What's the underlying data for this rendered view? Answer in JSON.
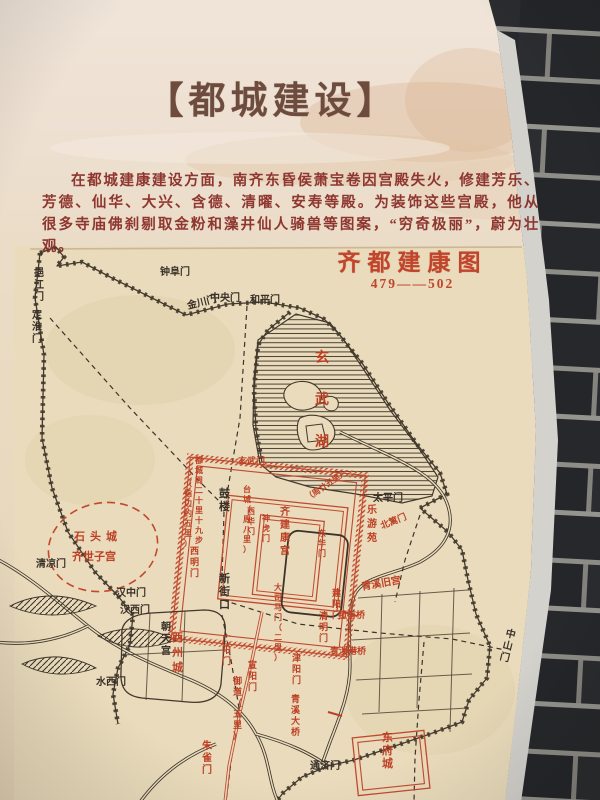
{
  "photo": {
    "colors": {
      "brick_wall": "#222426",
      "mortar": "#96948f",
      "panel_paper": "#ebdfca",
      "panel_edge": "#d4d2cd"
    }
  },
  "panel": {
    "title": "【都城建设】",
    "intro": "在都城建康建设方面，南齐东昏侯萧宝卷因宫殿失火，修建芳乐、芳德、仙华、大兴、含德、清曜、安寿等殿。为装饰这些宫殿，他从很多寺庙佛刹剔取金粉和藻井仙人骑兽等图案，“穷奇极丽”，蔚为壮观。"
  },
  "map": {
    "title": "齐都建康图",
    "period": "479——502",
    "colors": {
      "red": "#bd4026",
      "ink": "#39312a",
      "paper": "#e9dbbb"
    },
    "labels": [
      {
        "t": "钟阜门",
        "x": 160,
        "y": 275,
        "c": "ink",
        "o": "h",
        "s": 10
      },
      {
        "t": "金川门",
        "x": 188,
        "y": 309,
        "c": "ink",
        "o": "h",
        "s": 10,
        "r": -14
      },
      {
        "t": "中央门",
        "x": 210,
        "y": 301,
        "c": "ink",
        "o": "h",
        "s": 10
      },
      {
        "t": "和平门",
        "x": 250,
        "y": 303,
        "c": "ink",
        "o": "h",
        "s": 10
      },
      {
        "t": "挹江门",
        "x": 34,
        "y": 276,
        "c": "ink",
        "o": "v",
        "s": 10
      },
      {
        "t": "定淮门",
        "x": 32,
        "y": 318,
        "c": "ink",
        "o": "v",
        "s": 10
      },
      {
        "t": "太平门",
        "x": 373,
        "y": 501,
        "c": "ink",
        "o": "h",
        "s": 10
      },
      {
        "t": "清凉门",
        "x": 36,
        "y": 567,
        "c": "ink",
        "o": "h",
        "s": 10
      },
      {
        "t": "汉中门",
        "x": 116,
        "y": 596,
        "c": "ink",
        "o": "h",
        "s": 10
      },
      {
        "t": "汉西门",
        "x": 120,
        "y": 613,
        "c": "ink",
        "o": "h",
        "s": 10
      },
      {
        "t": "水西门",
        "x": 96,
        "y": 685,
        "c": "ink",
        "o": "h",
        "s": 10
      },
      {
        "t": "通济门",
        "x": 310,
        "y": 769,
        "c": "ink",
        "o": "h",
        "s": 10
      },
      {
        "t": "中山门",
        "x": 505,
        "y": 636,
        "c": "ink",
        "o": "v",
        "s": 10,
        "r": 14
      },
      {
        "t": "鼓楼",
        "x": 219,
        "y": 497,
        "c": "ink",
        "o": "v",
        "s": 11
      },
      {
        "t": "新街口",
        "x": 219,
        "y": 582,
        "c": "ink",
        "o": "v",
        "s": 11
      },
      {
        "t": "朝天宫",
        "x": 161,
        "y": 630,
        "c": "ink",
        "o": "v",
        "s": 10
      },
      {
        "t": "玄武门",
        "x": 238,
        "y": 464,
        "c": "red",
        "o": "h",
        "s": 9
      },
      {
        "t": "玄武湖",
        "x": 315,
        "y": 362,
        "c": "red",
        "o": "v",
        "s": 14,
        "ls": 28
      },
      {
        "t": "乐游苑",
        "x": 367,
        "y": 513,
        "c": "red",
        "o": "v",
        "s": 10,
        "ls": 4
      },
      {
        "t": "北篱门",
        "x": 382,
        "y": 529,
        "c": "red",
        "o": "h",
        "s": 9,
        "r": -22
      },
      {
        "t": "青溪旧宫",
        "x": 362,
        "y": 590,
        "c": "red",
        "o": "h",
        "s": 10,
        "r": -10
      },
      {
        "t": "菰首桥",
        "x": 338,
        "y": 618,
        "c": "red",
        "o": "h",
        "s": 9
      },
      {
        "t": "青溪港桥",
        "x": 330,
        "y": 654,
        "c": "red",
        "o": "h",
        "s": 9
      },
      {
        "t": "青溪大桥",
        "x": 291,
        "y": 702,
        "c": "red",
        "o": "v",
        "s": 9
      },
      {
        "t": "石头城",
        "x": 74,
        "y": 540,
        "c": "red",
        "o": "h",
        "s": 11,
        "ls": 5
      },
      {
        "t": "齐世子宫",
        "x": 72,
        "y": 560,
        "c": "red",
        "o": "h",
        "s": 11
      },
      {
        "t": "西州城",
        "x": 172,
        "y": 641,
        "c": "red",
        "o": "v",
        "s": 11,
        "ls": 4
      },
      {
        "t": "东府城",
        "x": 382,
        "y": 741,
        "c": "red",
        "o": "v",
        "s": 11,
        "ls": 2
      },
      {
        "t": "御道（五里）",
        "x": 233,
        "y": 684,
        "c": "red",
        "o": "v",
        "s": 9
      },
      {
        "t": "朱雀门",
        "x": 202,
        "y": 749,
        "c": "red",
        "o": "v",
        "s": 10
      },
      {
        "t": "齐建康宫",
        "x": 280,
        "y": 515,
        "c": "red",
        "o": "v",
        "s": 10,
        "ls": 3
      },
      {
        "t": "台城（周八里）",
        "x": 243,
        "y": 492,
        "c": "red",
        "o": "v",
        "s": 8
      },
      {
        "t": "大司马门（二里）",
        "x": 274,
        "y": 590,
        "c": "red",
        "o": "v",
        "s": 8
      },
      {
        "t": "西华门",
        "x": 247,
        "y": 514,
        "c": "red",
        "o": "v",
        "s": 8
      },
      {
        "t": "神虎门",
        "x": 262,
        "y": 521,
        "c": "red",
        "o": "v",
        "s": 8
      },
      {
        "t": "东华门",
        "x": 318,
        "y": 536,
        "c": "red",
        "o": "v",
        "s": 8
      },
      {
        "t": "西明门",
        "x": 190,
        "y": 554,
        "c": "red",
        "o": "v",
        "s": 9
      },
      {
        "t": "广阳门",
        "x": 222,
        "y": 642,
        "c": "red",
        "o": "v",
        "s": 9
      },
      {
        "t": "宣阳门",
        "x": 248,
        "y": 668,
        "c": "red",
        "o": "v",
        "s": 9
      },
      {
        "t": "津阳门",
        "x": 292,
        "y": 661,
        "c": "red",
        "o": "v",
        "s": 9
      },
      {
        "t": "清明门",
        "x": 319,
        "y": 619,
        "c": "red",
        "o": "v",
        "s": 9
      },
      {
        "t": "建阳门",
        "x": 332,
        "y": 596,
        "c": "red",
        "o": "v",
        "s": 9
      },
      {
        "t": "都城周二十里十九步",
        "x": 195,
        "y": 463,
        "c": "red",
        "o": "v",
        "s": 8
      },
      {
        "t": "（指边约五里）",
        "x": 184,
        "y": 486,
        "c": "red",
        "o": "v",
        "s": 8
      },
      {
        "t": "（周廿五里）",
        "x": 308,
        "y": 501,
        "c": "red",
        "o": "h",
        "s": 8,
        "r": -35
      }
    ]
  }
}
